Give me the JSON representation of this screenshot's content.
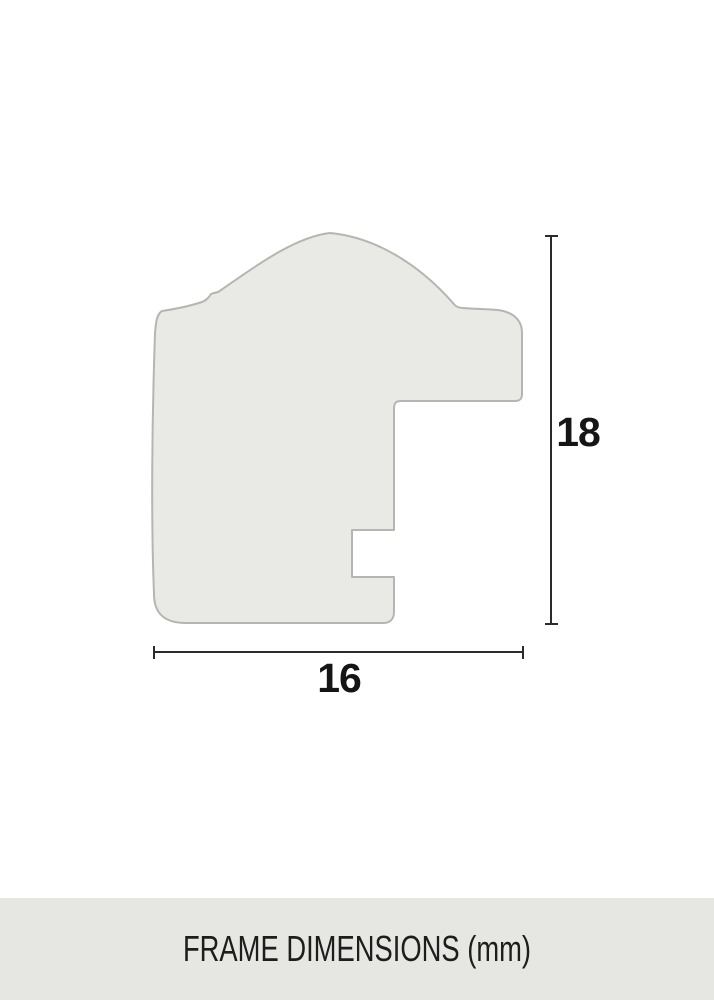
{
  "diagram": {
    "height_label": "18",
    "width_label": "16",
    "colors": {
      "profile_fill": "#e9e9e5",
      "profile_stroke": "#b5b5b1",
      "dimension_line": "#2b2b2b",
      "label_text": "#151515"
    }
  },
  "footer": {
    "label": "FRAME DIMENSIONS (mm)",
    "background": "#e6e6e2"
  }
}
